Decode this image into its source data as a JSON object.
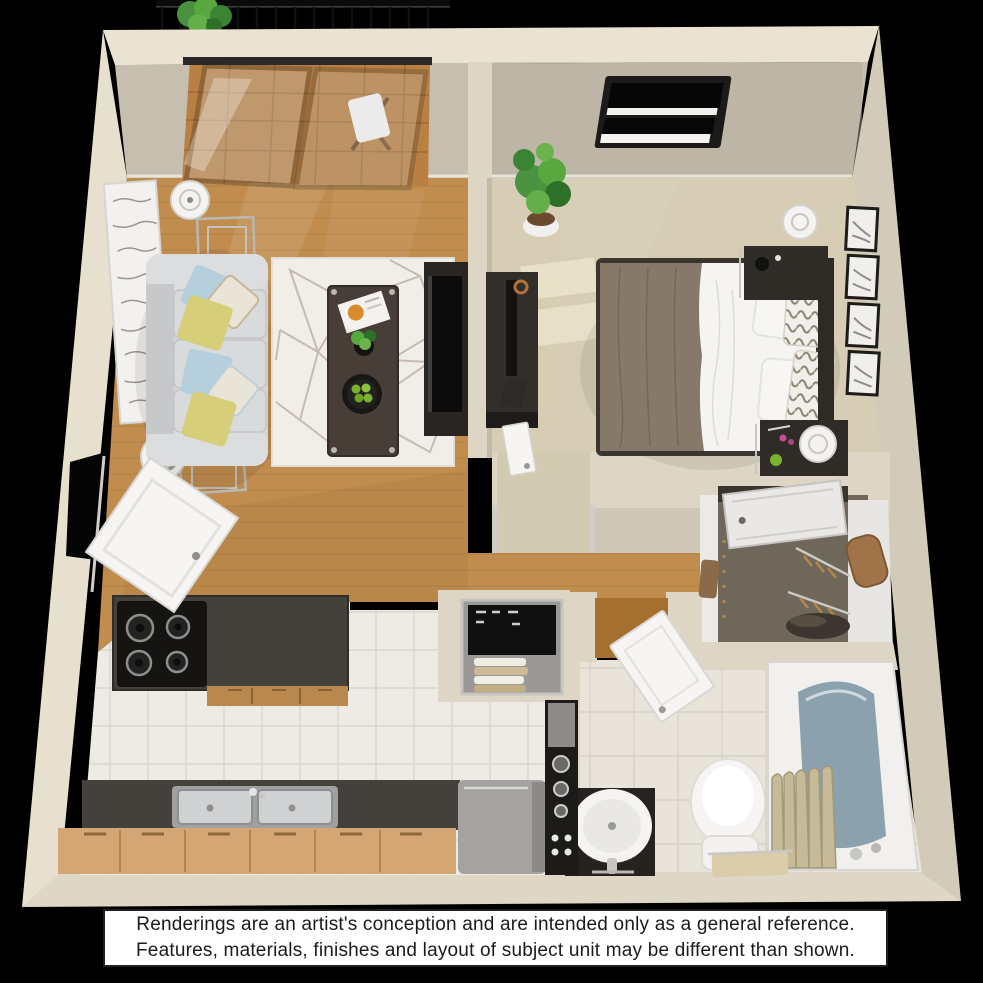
{
  "scene": {
    "type": "3d-floor-plan-rendering",
    "unit": "one-bedroom one-bath apartment with balcony",
    "rooms": [
      "balcony",
      "living-room",
      "bedroom",
      "walk-in-closet",
      "bathroom",
      "kitchen",
      "entry-hall",
      "laundry-nook"
    ],
    "furniture": {
      "living_room": [
        "wall-art",
        "floor-lamp",
        "nesting-side-tables",
        "sofa-with-pillows",
        "area-rug",
        "coffee-table",
        "tv-console",
        "television"
      ],
      "bedroom": [
        "potted-plant",
        "window-with-blinds",
        "dresser-with-tv",
        "bed",
        "nightstand-lamps",
        "picture-frames",
        "floor-mats"
      ],
      "kitchen": [
        "island-with-stove",
        "double-sink-counter",
        "wood-cabinets",
        "refrigerator",
        "shelf-column",
        "stacked-laundry"
      ],
      "bathroom": [
        "vanity-sink",
        "toilet",
        "bathtub",
        "shower-curtain",
        "towel"
      ],
      "closet": [
        "closet-door",
        "hanging-rods",
        "duffel-bag",
        "shoe-pile"
      ],
      "balcony": [
        "railing",
        "potted-plant",
        "deck",
        "folding-chair",
        "sliding-glass-door"
      ]
    }
  },
  "disclaimer": {
    "line1": "Renderings are an artist's conception and are intended only as a general reference.",
    "line2": "Features, materials, finishes and layout of subject unit may be different than shown."
  },
  "palette": {
    "background": "#000000",
    "wall_left": "#e7e0ce",
    "wall_right": "#d2cbb9",
    "wall_top_edge": "#eae3d1",
    "wall_top_face": "#c6beae",
    "wall_bottom": "#ded7c5",
    "wall_inner": "#ddd6c4",
    "wood_floor": "#c18d4f",
    "carpet_bedroom": "#d6cdb4",
    "carpet_alcove": "#d3cab2",
    "carpet_closet": "#6f675a",
    "tile_kitchen": "#eeebe4",
    "tile_bath": "#e9e4da",
    "rug": "#f1eeea",
    "sofa": "#d4d5d7",
    "pillow_yellow": "#d6ce79",
    "pillow_blue": "#b5cfdd",
    "blanket": "#87796a",
    "bed_white": "#f5f4f2",
    "dark_furniture": "#322e2a",
    "counter_dark": "#44403c",
    "island_cabinet": "#b9884f",
    "counter_cabinet": "#d3a674",
    "fridge": "#a4a3a1",
    "door_white": "#f6f5f3",
    "deck_wood": "#b97f43",
    "railing_black": "#0b0b0b",
    "plant_green": "#4a9240",
    "tub_water": "#8ba1ae",
    "curtain_beige": "#c6ba99",
    "art_white": "#f2f1ef",
    "frame_black": "#1c1b1a",
    "chrome": "#c9c7c3",
    "accent_lime": "#7ab32f",
    "accent_magenta": "#c84f97",
    "bag_brown": "#a07448",
    "towel_tan": "#d9cdaa"
  }
}
